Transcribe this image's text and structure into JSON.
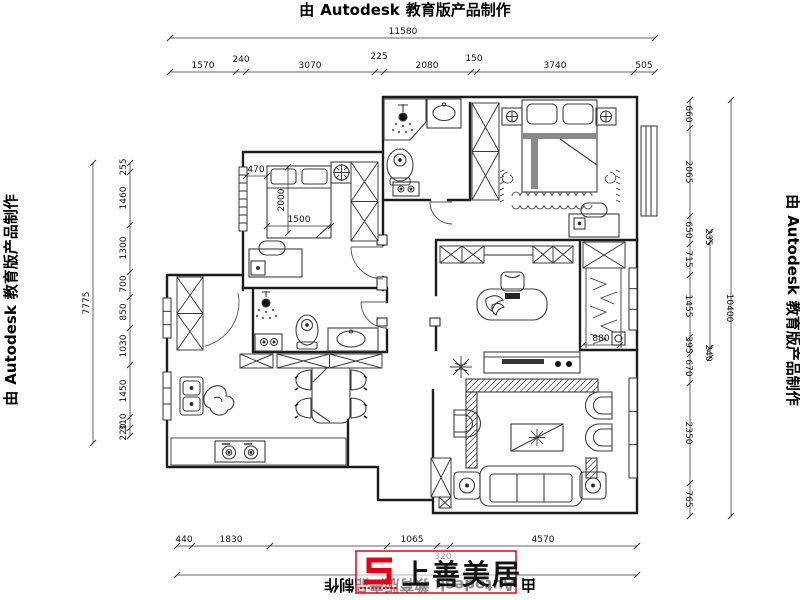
{
  "border": {
    "prefix": "由",
    "brand": "Autodesk",
    "suffix": "教育版产品制作"
  },
  "logo": {
    "brand": "上善美居",
    "color": "#e60012"
  },
  "dims": {
    "top_total": "11580",
    "top_segments": [
      "1570",
      "240",
      "3070",
      "225",
      "2080",
      "150",
      "3740",
      "505"
    ],
    "bottom_segments": [
      "440",
      "1830",
      "1065",
      "320",
      "4570"
    ],
    "left_total": "7775",
    "left_segments": [
      "255",
      "1460",
      "1300",
      "700",
      "850",
      "1030",
      "1450",
      "310",
      "220"
    ],
    "right_total": "10400",
    "right_segments": [
      "660",
      "2065",
      "650",
      "715",
      "1455",
      "395",
      "670",
      "2350",
      "765"
    ],
    "right_inner": [
      "235",
      "240"
    ],
    "bed_gap": "470",
    "bed_width": "1500",
    "bed_length": "2000",
    "closet_width": "880"
  }
}
